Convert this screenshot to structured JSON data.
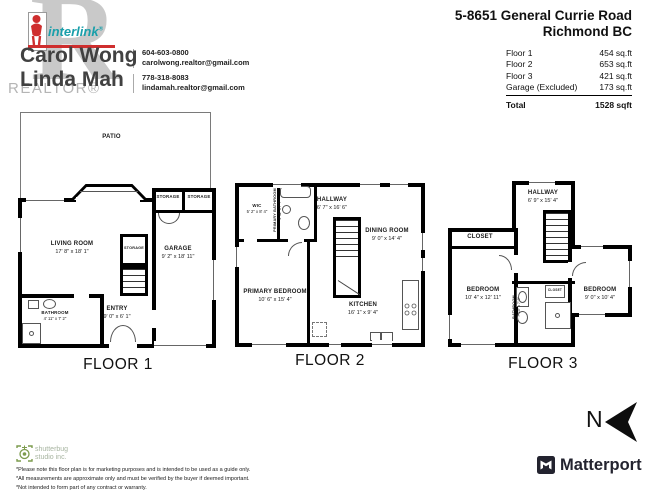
{
  "header": {
    "logo": {
      "realtor_r": "R",
      "realtor_text": "REALTOR®",
      "interlink_text": "interlink",
      "interlink_reg": "®"
    },
    "agents": [
      {
        "name": "Carol Wong",
        "phone": "604-603-0800",
        "email": "carolwong.realtor@gmail.com"
      },
      {
        "name": "Linda Mah",
        "phone": "778-318-8083",
        "email": "lindamah.realtor@gmail.com"
      }
    ],
    "address_line1": "5-8651 General Currie Road",
    "address_line2": "Richmond BC",
    "area_table": {
      "rows": [
        {
          "label": "Floor 1",
          "value": "454 sq.ft"
        },
        {
          "label": "Floor 2",
          "value": "653 sq.ft"
        },
        {
          "label": "Floor 3",
          "value": "421 sq.ft"
        },
        {
          "label": "Garage (Excluded)",
          "value": "173 sq.ft"
        }
      ],
      "total_label": "Total",
      "total_value": "1528 sqft"
    }
  },
  "floors": [
    {
      "label": "FLOOR 1",
      "rooms": {
        "patio": {
          "name": "PATIO"
        },
        "living": {
          "name": "LIVING ROOM",
          "dims": "17' 8\" x 18' 1\""
        },
        "garage": {
          "name": "GARAGE",
          "dims": "9' 2\" x 18' 11\""
        },
        "entry": {
          "name": "ENTRY",
          "dims": "9' 0\" x 6' 1\""
        },
        "bathroom": {
          "name": "BATHROOM",
          "dims": "4' 11\" x 7' 2\""
        },
        "storage_left": {
          "name": "STORAGE"
        },
        "storage_right": {
          "name": "STORAGE"
        },
        "storage_mid": {
          "name": "STORAGE"
        }
      }
    },
    {
      "label": "FLOOR 2",
      "rooms": {
        "wic": {
          "name": "WIC",
          "dims": "5' 2\" x 8' 4\""
        },
        "primary_bathroom": {
          "name": "PRIMARY BATHROOM",
          "dims": "4' 11\" x 7' 7\""
        },
        "hallway": {
          "name": "HALLWAY",
          "dims": "6' 7\" x 16' 6\""
        },
        "dining": {
          "name": "DINING ROOM",
          "dims": "9' 0\" x 14' 4\""
        },
        "primary_bedroom": {
          "name": "PRIMARY BEDROOM",
          "dims": "10' 6\" x 15' 4\""
        },
        "kitchen": {
          "name": "KITCHEN",
          "dims": "16' 1\" x 9' 4\""
        }
      }
    },
    {
      "label": "FLOOR 3",
      "rooms": {
        "hallway": {
          "name": "HALLWAY",
          "dims": "6' 9\" x 15' 4\""
        },
        "closet": {
          "name": "CLOSET"
        },
        "bedroom_left": {
          "name": "BEDROOM",
          "dims": "10' 4\" x 12' 11\""
        },
        "bedroom_right": {
          "name": "BEDROOM",
          "dims": "9' 0\" x 10' 4\""
        },
        "bathroom": {
          "name": "BATHROOM",
          "dims": "7' 10\" x 7' 0\""
        },
        "closet_small": {
          "name": "CLOSET"
        }
      }
    }
  ],
  "footer": {
    "studio": {
      "line1": "shutterbug",
      "line2": "studio inc."
    },
    "disclaimers": [
      "*Please note this floor plan is for marketing purposes and is intended to be used as a guide only.",
      "*All measurements are approximate only and must be verified by the buyer if deemed important.",
      "*Not intended to form part of any contract or warranty."
    ],
    "north_label": "N",
    "matterport_label": "Matterport"
  },
  "colors": {
    "wall": "#000000",
    "accent_red": "#cf2e2e",
    "interlink_teal": "#199faa",
    "logo_gray": "#c9c9c9",
    "studio_green": "#7c9b4d",
    "matterport_dark": "#23232f"
  }
}
